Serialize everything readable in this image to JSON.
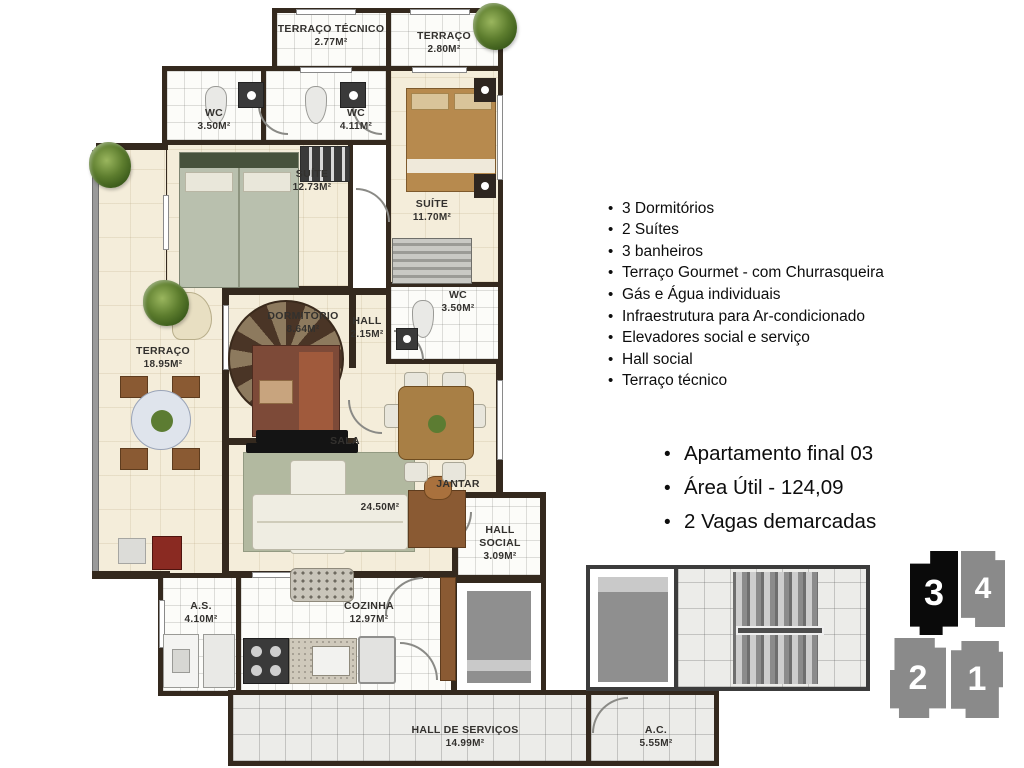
{
  "plan": {
    "rooms": [
      {
        "id": "terraco-tecnico",
        "name": "TERRAÇO TÉCNICO",
        "area": "2.77M²"
      },
      {
        "id": "terraco-norte",
        "name": "TERRAÇO",
        "area": "2.80M²"
      },
      {
        "id": "wc-1",
        "name": "WC",
        "area": "3.50M²"
      },
      {
        "id": "wc-2",
        "name": "WC",
        "area": "4.11M²"
      },
      {
        "id": "suite-1",
        "name": "SUÍTE",
        "area": "12.73M²"
      },
      {
        "id": "suite-2",
        "name": "SUÍTE",
        "area": "11.70M²"
      },
      {
        "id": "terraco",
        "name": "TERRAÇO",
        "area": "18.95M²"
      },
      {
        "id": "dormitorio",
        "name": "DORMITÓRIO",
        "area": "8.64M²"
      },
      {
        "id": "hall",
        "name": "HALL",
        "area": "2.15M²"
      },
      {
        "id": "wc-3",
        "name": "WC",
        "area": "3.50M²"
      },
      {
        "id": "sala",
        "name": "SALA",
        "area": "24.50M²"
      },
      {
        "id": "jantar",
        "name": "JANTAR",
        "area": ""
      },
      {
        "id": "hall-social",
        "name": "HALL SOCIAL",
        "area": "3.09M²"
      },
      {
        "id": "area-servico",
        "name": "A.S.",
        "area": "4.10M²"
      },
      {
        "id": "cozinha",
        "name": "COZINHA",
        "area": "12.97M²"
      },
      {
        "id": "hall-servicos",
        "name": "HALL DE SERVIÇOS",
        "area": "14.99M²"
      },
      {
        "id": "ac",
        "name": "A.C.",
        "area": "5.55M²"
      }
    ]
  },
  "features": {
    "bullet": "•",
    "items": [
      "3 Dormitórios",
      "2 Suítes",
      "3 banheiros",
      "Terraço Gourmet - com Churrasqueira",
      "Gás e Água individuais",
      "Infraestrutura para Ar-condicionado",
      "Elevadores social e serviço",
      "Hall social",
      "Terraço técnico"
    ]
  },
  "highlights": {
    "bullet": "•",
    "items": [
      "Apartamento final 03",
      "Área Útil - 124,09",
      "2 Vagas demarcadas"
    ]
  },
  "keyplan": {
    "units": [
      {
        "number": "3",
        "highlighted": true
      },
      {
        "number": "4",
        "highlighted": false
      },
      {
        "number": "2",
        "highlighted": false
      },
      {
        "number": "1",
        "highlighted": false
      }
    ]
  },
  "colors": {
    "wall": "#34291e",
    "floor_cream": "#f4edda",
    "floor_tile": "#fcfcf9",
    "service_gray": "#8f8f8f",
    "unit_highlight": "#0a0a0a",
    "unit_gray": "#8a8a8a"
  }
}
